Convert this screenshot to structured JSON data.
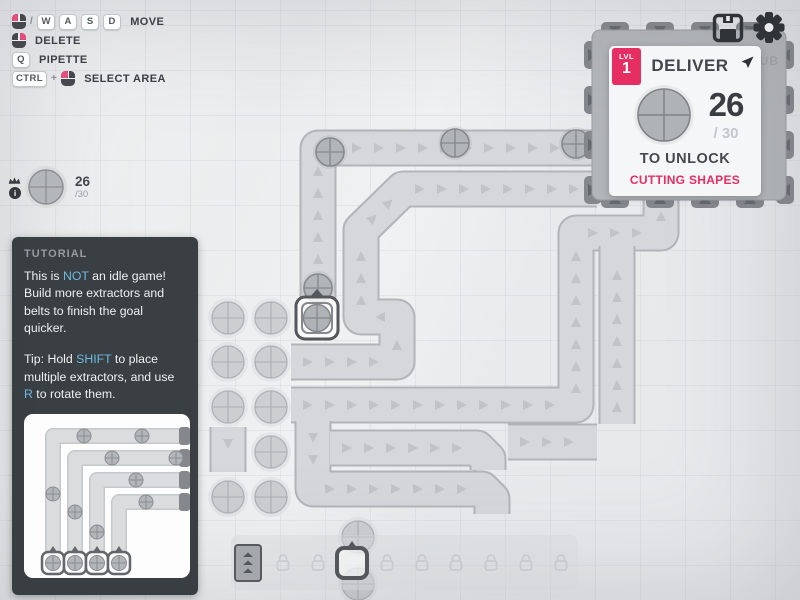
{
  "keybind_hints": [
    {
      "mouse": "left",
      "separator": "/",
      "keys": [
        "W",
        "A",
        "S",
        "D"
      ],
      "label": "MOVE"
    },
    {
      "mouse": "right",
      "separator": "",
      "keys": [],
      "label": "DELETE"
    },
    {
      "mouse": "",
      "separator": "",
      "keys": [
        "Q"
      ],
      "label": "PIPETTE"
    },
    {
      "mouse": "left",
      "separator": "+",
      "keys": [
        "CTRL"
      ],
      "label": "SELECT AREA"
    }
  ],
  "goal_pin": {
    "count": "26",
    "total": "/30"
  },
  "level_panel": {
    "badge_label": "LVL",
    "badge_number": "1",
    "title": "DELIVER",
    "count": "26",
    "total": "/ 30",
    "unlock_text": "TO UNLOCK",
    "reward_text": "CUTTING SHAPES"
  },
  "hub_label": "HUB",
  "tutorial": {
    "header": "TUTORIAL",
    "p1": {
      "a": "This is ",
      "b": "NOT",
      "c": " an idle game! Build more extractors and belts to finish the goal quicker."
    },
    "p2": {
      "a": "Tip: Hold ",
      "b": "SHIFT",
      "c": " to place multiple extractors, and use ",
      "d": "R",
      "e": " to rotate them."
    }
  },
  "hotbar": {
    "slots": [
      "belt",
      "locked",
      "locked",
      "miner-selected",
      "locked",
      "locked",
      "locked",
      "locked",
      "locked",
      "locked"
    ]
  },
  "icons": {
    "save": "floppy-disk",
    "settings": "gear",
    "goal_crown": "crown",
    "goal_info": "info",
    "panel_pin": "location-pin",
    "mouse": "mouse-button",
    "lock": "padlock"
  },
  "colors": {
    "accent_pink": "#e72e62",
    "link_blue": "#6cbbe0",
    "belt_fill": "#d5d7da",
    "belt_border": "#b2b5b8",
    "chevron": "#c0c3c7",
    "hub_body": "#b3b6b9",
    "hub_tab": "#84878b",
    "hub_arrow": "#65686c",
    "resource_fill": "#caccce",
    "resource_stroke": "#aaadb0",
    "item_fill": "#b2b5b8",
    "item_stroke": "#86898d",
    "panel_bg": "#f5f6f7",
    "tutorial_bg": "#343a3e"
  },
  "world": {
    "belts": [
      {
        "points": [
          [
            318,
            298
          ],
          [
            318,
            148
          ],
          [
            597,
            148
          ]
        ]
      },
      {
        "points": [
          [
            291,
            362
          ],
          [
            397,
            362
          ],
          [
            397,
            317
          ],
          [
            361,
            317
          ],
          [
            361,
            230
          ],
          [
            403,
            189
          ],
          [
            597,
            189
          ]
        ]
      },
      {
        "points": [
          [
            291,
            405
          ],
          [
            576,
            405
          ],
          [
            576,
            233
          ],
          [
            661,
            233
          ],
          [
            661,
            199
          ]
        ]
      },
      {
        "points": [
          [
            617,
            424
          ],
          [
            617,
            246
          ]
        ]
      },
      {
        "points": [
          [
            508,
            442
          ],
          [
            597,
            442
          ]
        ]
      },
      {
        "points": [
          [
            313,
            421
          ],
          [
            313,
            489
          ],
          [
            482,
            489
          ],
          [
            492,
            499
          ],
          [
            492,
            514
          ]
        ]
      },
      {
        "points": [
          [
            330,
            448
          ],
          [
            477,
            448
          ],
          [
            488,
            459
          ],
          [
            488,
            470
          ]
        ]
      },
      {
        "points": [
          [
            228,
            427
          ],
          [
            228,
            472
          ]
        ]
      }
    ],
    "belt_items": [
      [
        318,
        288
      ],
      [
        330,
        152
      ],
      [
        455,
        143
      ],
      [
        576,
        144
      ]
    ],
    "resources": [
      [
        228,
        318
      ],
      [
        271,
        318
      ],
      [
        228,
        362
      ],
      [
        271,
        362
      ],
      [
        228,
        407
      ],
      [
        271,
        407
      ],
      [
        271,
        452
      ],
      [
        228,
        497
      ],
      [
        271,
        497
      ],
      [
        358,
        537
      ],
      [
        358,
        584
      ]
    ],
    "hub": {
      "x": 592,
      "y": 30,
      "w": 194,
      "h": 170,
      "tab_xs": [
        615,
        660,
        705,
        750
      ],
      "tab_ys": [
        55,
        100,
        145,
        190
      ]
    }
  }
}
